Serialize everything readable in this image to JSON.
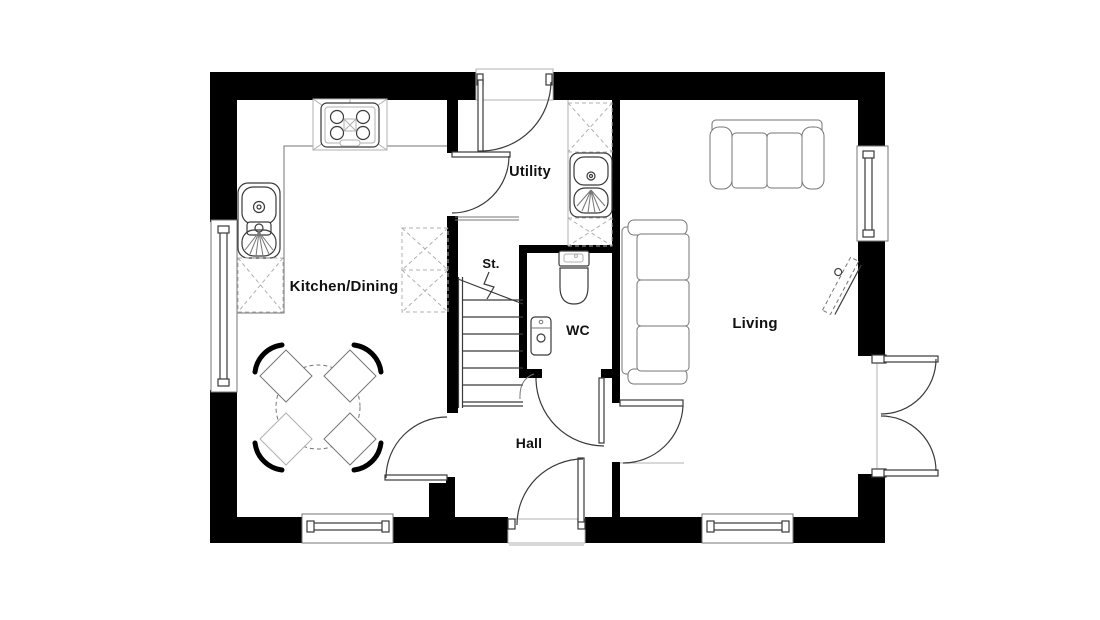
{
  "plan": {
    "type": "ground-floor-plan",
    "rooms": {
      "kitchen_dining": {
        "label": "Kitchen/Dining"
      },
      "utility": {
        "label": "Utility"
      },
      "store": {
        "label": "St."
      },
      "wc": {
        "label": "WC"
      },
      "hall": {
        "label": "Hall"
      },
      "living": {
        "label": "Living"
      }
    },
    "fixtures": [
      "hob-extractor",
      "kitchen-sink",
      "dishwasher",
      "tall-unit",
      "dining-table",
      "dining-chair",
      "utility-counter",
      "utility-sink",
      "toilet",
      "basin",
      "staircase",
      "sofa-two-seater",
      "sofa-three-seater",
      "tv-unit",
      "front-door",
      "back-door",
      "internal-doors",
      "french-doors",
      "windows"
    ],
    "colors": {
      "wall": "#000000",
      "line_dark": "#3a3a3a",
      "line_mid": "#767676",
      "line_light": "#b0b0b0",
      "background": "#ffffff"
    }
  }
}
